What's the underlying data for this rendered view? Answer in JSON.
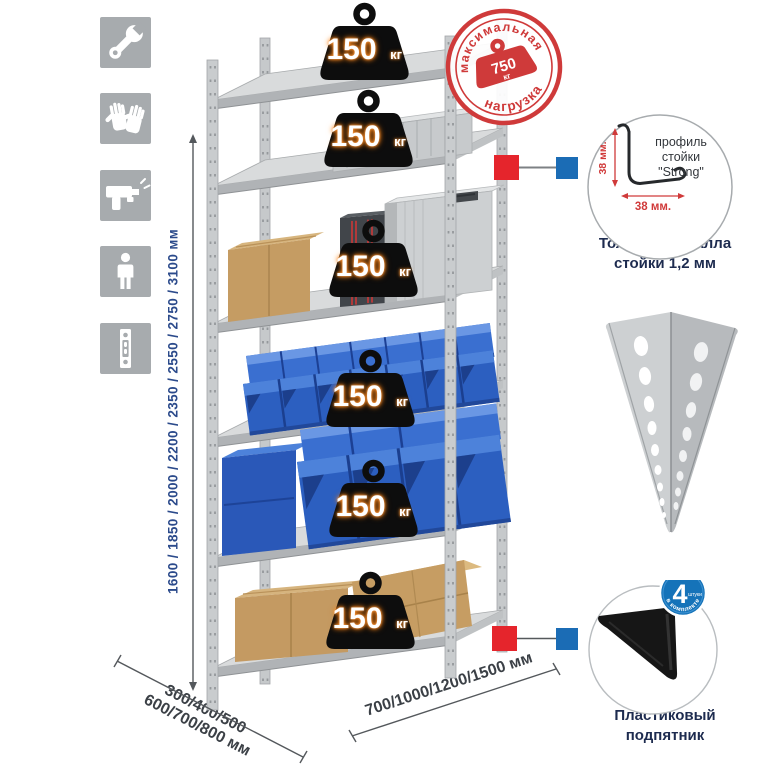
{
  "canvas": {
    "background": "#ffffff"
  },
  "left_icons": {
    "items": [
      {
        "icon": "wrench-icon"
      },
      {
        "icon": "gloves-icon"
      },
      {
        "icon": "drill-icon"
      },
      {
        "icon": "person-icon"
      },
      {
        "icon": "perforated-post-icon"
      }
    ]
  },
  "height_dimension": {
    "label": "1600 / 1850 / 2000 / 2200 / 2350 / 2550 / 2750 / 3100 мм",
    "color": "#2b4a8b"
  },
  "rack": {
    "load_unit": "кг",
    "shelves": [
      {
        "load": "150"
      },
      {
        "load": "150"
      },
      {
        "load": "150"
      },
      {
        "load": "150"
      },
      {
        "load": "150"
      },
      {
        "load": "150"
      }
    ]
  },
  "stamp": {
    "arc_top": "максимальная",
    "arc_bottom": "нагрузка",
    "value": "750",
    "unit": "кг",
    "color": "#cf3a3a"
  },
  "profile_detail": {
    "label_lines": [
      "профиль",
      "стойки",
      "\"Strong\""
    ],
    "vertical_dim": "38 мм.",
    "horizontal_dim": "38 мм.",
    "dim_color": "#d03a3a",
    "caption_lines": [
      "Толщина металла",
      "стойки 1,2 мм"
    ]
  },
  "foot_detail": {
    "badge_value": "4",
    "badge_small": "штуки",
    "badge_arc": "в комплекте",
    "badge_color": "#1573b9",
    "caption_lines": [
      "Пластиковый",
      "подпятник"
    ]
  },
  "depth_dimension": {
    "line1": "300/400/500",
    "line2": "600/700/800 мм"
  },
  "width_dimension": {
    "label": "700/1000/1200/1500 мм"
  },
  "markers": {
    "red": "#e5252c",
    "blue": "#1b6cb5"
  }
}
